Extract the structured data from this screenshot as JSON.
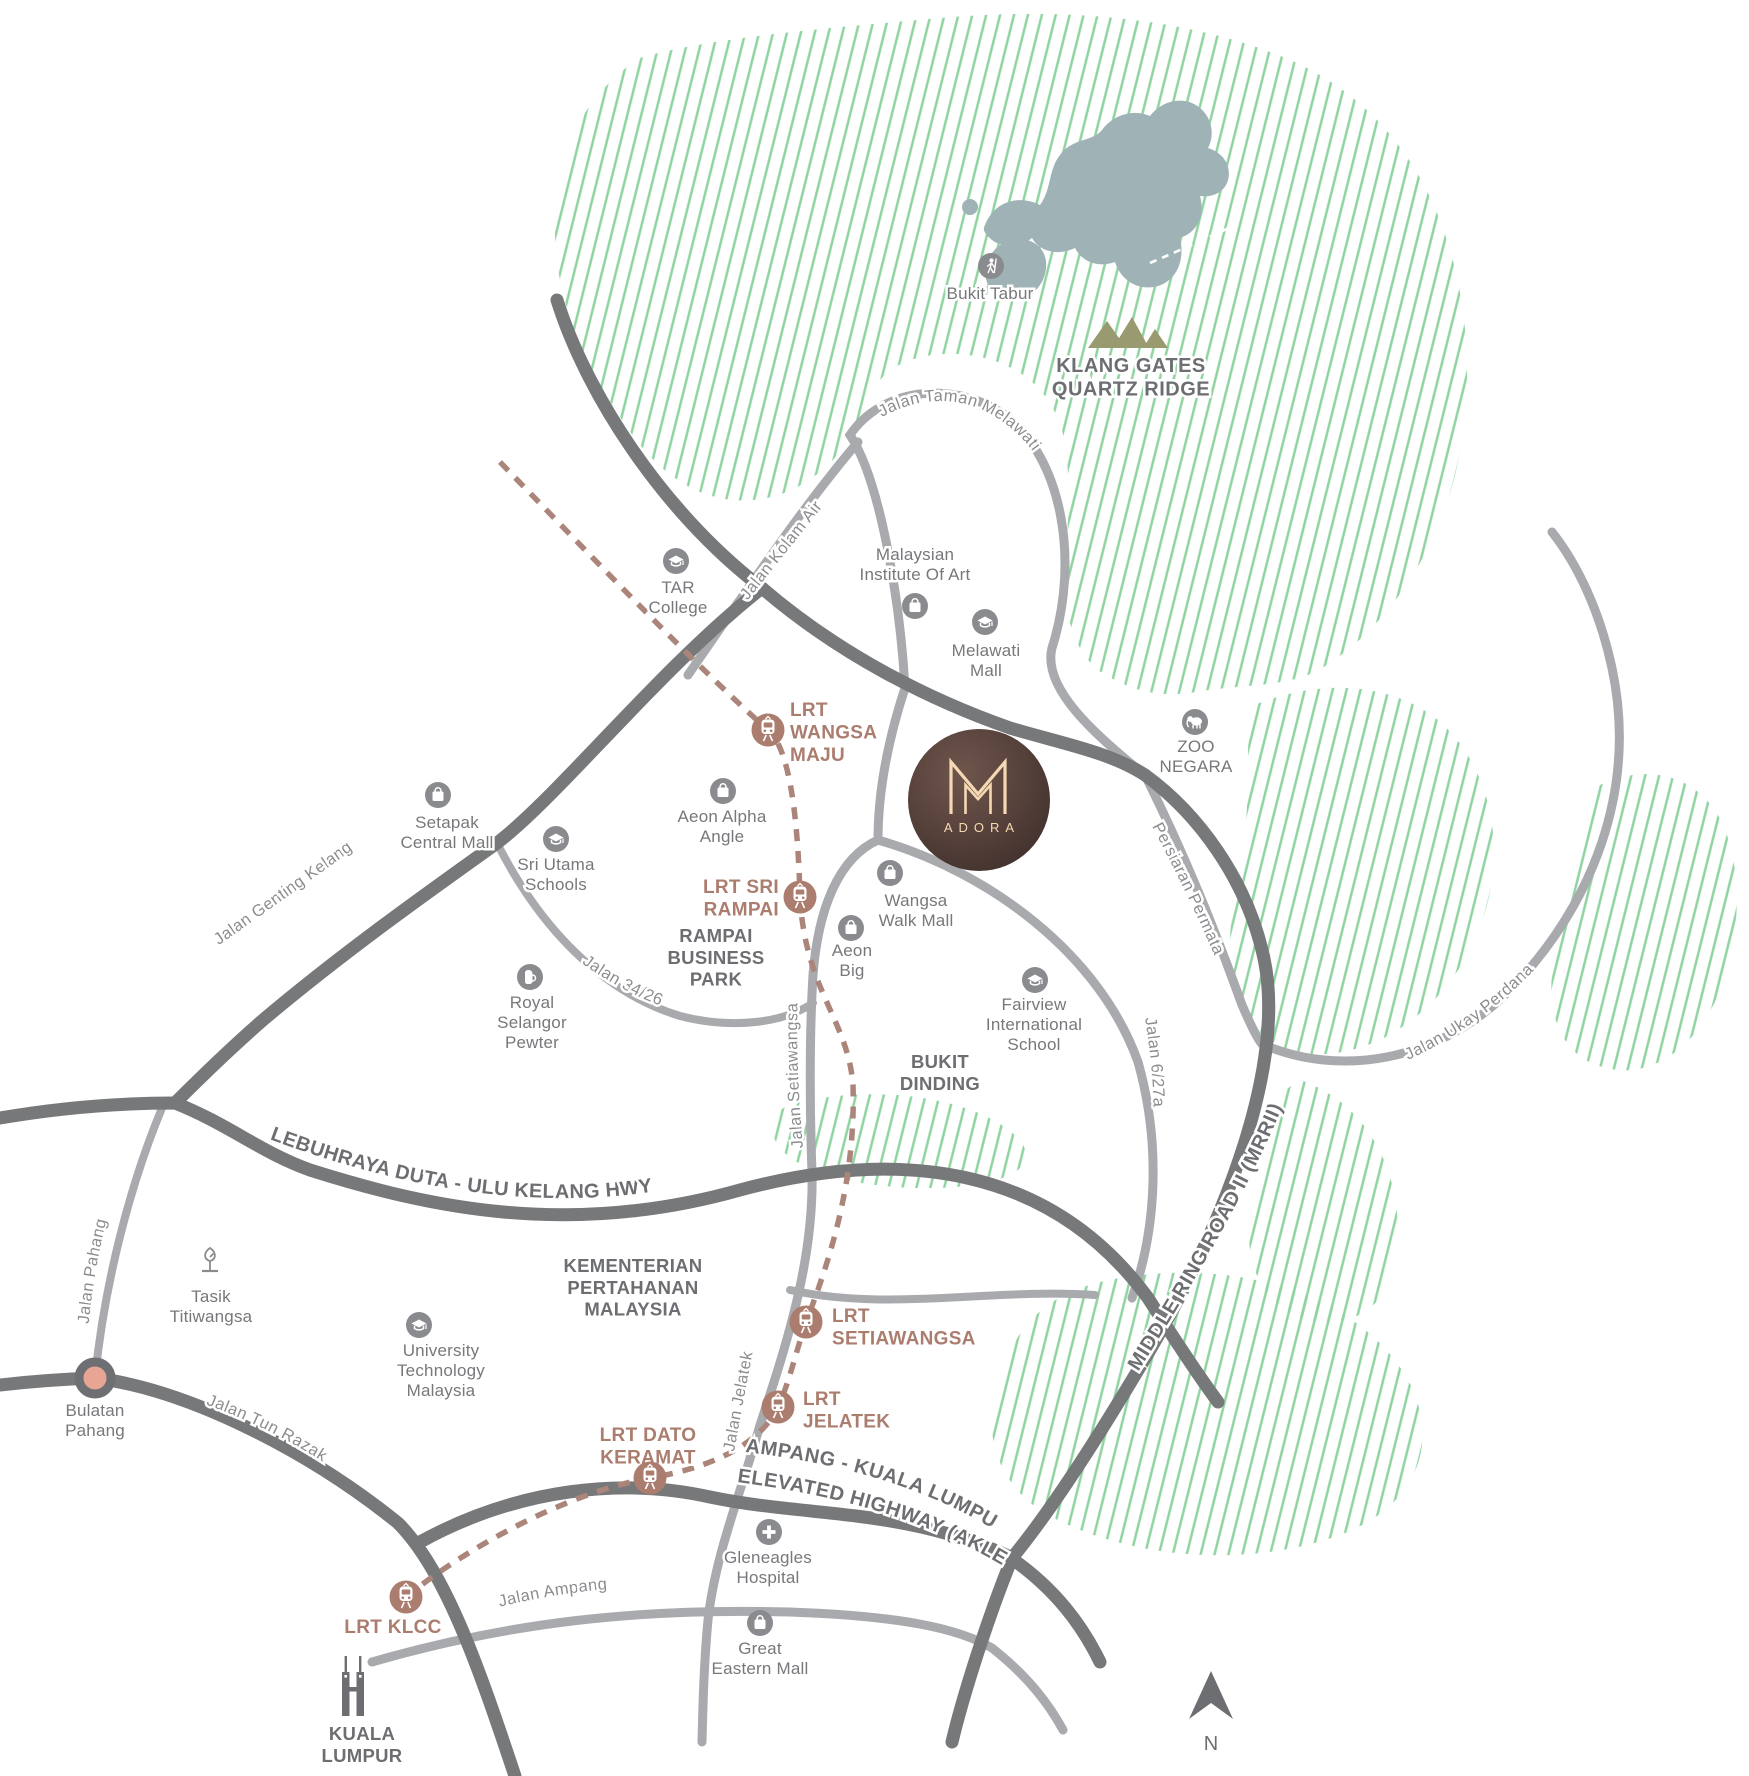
{
  "project": {
    "monogram": "M",
    "name": "ADORA"
  },
  "compass": {
    "north": "N"
  },
  "colors": {
    "hatch_green": "#8fd3a0",
    "lake_blue_gray": "#9fb3b6",
    "road_dark_gray": "#77787a",
    "road_light_gray": "#a8aaad",
    "lrt_brown": "#ab7d6e",
    "roundabout_salmon": "#e8a593",
    "ridge_olive": "#9a9a70",
    "logo_brown": "#4a3834",
    "logo_cream": "#f6d9b4",
    "label_gray": "#6d6e71"
  },
  "natural": {
    "bukit_tabur": "Bukit Tabur",
    "klang_gates": "KLANG GATES\nQUARTZ RIDGE",
    "tasik_titiwangsa": "Tasik\nTitiwangsa",
    "bukit_dinding": "BUKIT\nDINDING"
  },
  "areas": {
    "rampai": "RAMPAI\nBUSINESS\nPARK",
    "kementerian": "KEMENTERIAN\nPERTAHANAN\nMALAYSIA",
    "kuala_lumpur": "KUALA\nLUMPUR",
    "bulatan": "Bulatan\nPahang"
  },
  "landmarks": [
    {
      "name": "TAR\nCollege",
      "icon": "graduation-cap"
    },
    {
      "name": "Malaysian\nInstitute Of Art",
      "icon": "shopping-bag"
    },
    {
      "name": "Melawati\nMall",
      "icon": "graduation-cap"
    },
    {
      "name": "Setapak\nCentral Mall",
      "icon": "shopping-bag"
    },
    {
      "name": "Sri Utama\nSchools",
      "icon": "graduation-cap"
    },
    {
      "name": "Aeon Alpha\nAngle",
      "icon": "shopping-bag"
    },
    {
      "name": "Wangsa\nWalk Mall",
      "icon": "shopping-bag"
    },
    {
      "name": "Aeon\nBig",
      "icon": "shopping-bag"
    },
    {
      "name": "Royal\nSelangor\nPewter",
      "icon": "tankard"
    },
    {
      "name": "Fairview\nInternational\nSchool",
      "icon": "graduation-cap"
    },
    {
      "name": "ZOO\nNEGARA",
      "icon": "animal"
    },
    {
      "name": "University\nTechnology\nMalaysia",
      "icon": "graduation-cap"
    },
    {
      "name": "Gleneagles\nHospital",
      "icon": "medical-cross"
    },
    {
      "name": "Great\nEastern Mall",
      "icon": "shopping-bag"
    }
  ],
  "stations": [
    {
      "name": "LRT\nWANGSA\nMAJU"
    },
    {
      "name": "LRT SRI\nRAMPAI"
    },
    {
      "name": "LRT\nSETIAWANGSA"
    },
    {
      "name": "LRT\nJELATEK"
    },
    {
      "name": "LRT DATO\nKERAMAT"
    },
    {
      "name": "LRT KLCC"
    }
  ],
  "roads": {
    "taman_melawati": "Jalan Taman Melawati",
    "kolam_air": "Jalan Kolam Air",
    "genting_kelang": "Jalan Genting Kelang",
    "ukay_perdana": "Jalan Ukay Perdana",
    "persiaran_permata": "Persiaran Permata",
    "mrr2": "MIDDLE RING ROAD II (MRRII)",
    "duta": "LEBUHRAYA DUTA - ULU KELANG HWY",
    "setiawangsa": "Jalan Setiawangsa",
    "jelatek": "Jalan Jelatek",
    "jalan_34_26": "Jalan 34/26",
    "jalan_6_27a": "Jalan 6/27a",
    "pahang": "Jalan Pahang",
    "tun_razak": "Jalan Tun Razak",
    "ampang": "Jalan Ampang",
    "akleh_line1": "AMPANG - KUALA LUMPUR",
    "akleh_line2": "ELEVATED HIGHWAY (AKLEH)"
  }
}
